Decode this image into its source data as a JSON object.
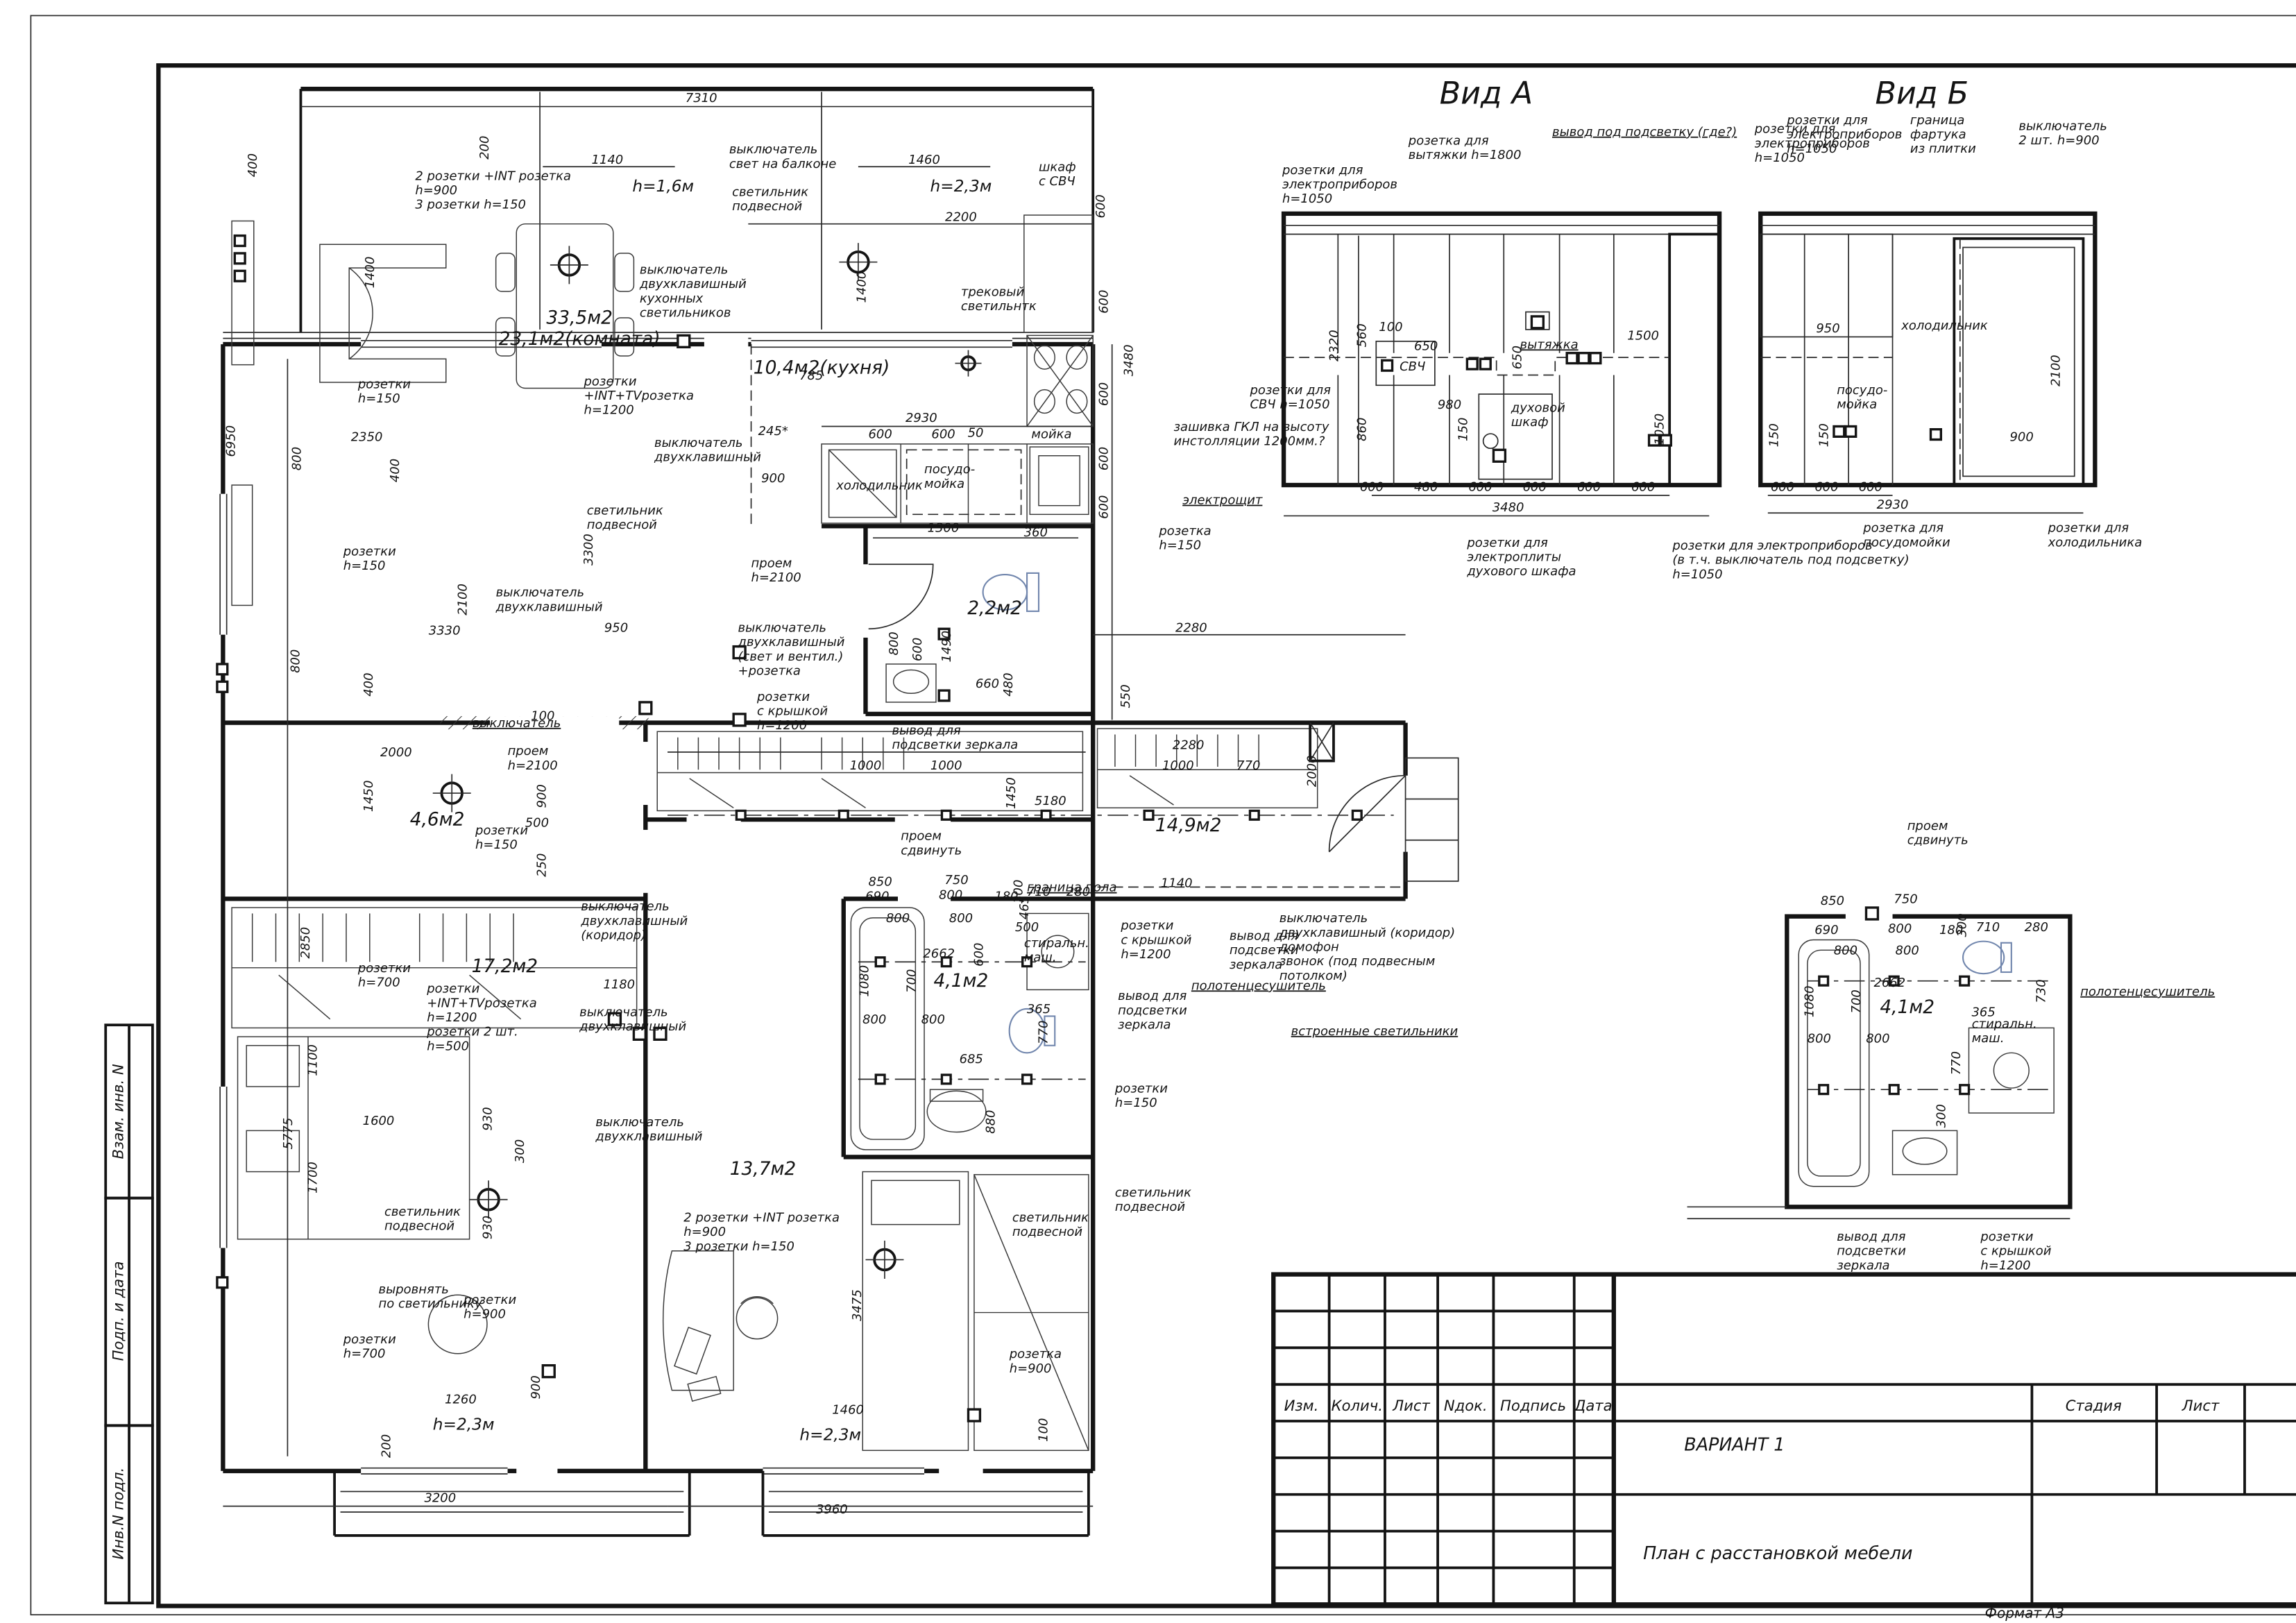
{
  "colors": {
    "line": "#141414",
    "toilet_outline": "#7186ad",
    "paper": "#ffffff"
  },
  "stamp": {
    "cells": [
      "Взам. инв. N",
      "Подп. и дата",
      "Инв.N подл."
    ]
  },
  "titleblock": {
    "cols": [
      "Изм.",
      "Колич.",
      "Лист",
      "Nдок.",
      "Подпись",
      "Дата"
    ],
    "variant": "ВАРИАНТ 1",
    "stage_label": "Стадия",
    "sheet_label": "Лист",
    "sheets_label": "Листов",
    "title": "План с расстановкой мебели",
    "format": "Формат А3"
  },
  "view_a": {
    "title": "Вид А",
    "labels": [
      {
        "t": "розетка для\nвытяжки h=1800"
      },
      {
        "t": "вывод под подсветку (где?)"
      },
      {
        "t": "розетки для\nэлектроприборов\nh=1050"
      },
      {
        "t": "розетки для\nэлектроприборов\nh=1050"
      },
      {
        "t": "вытяжка"
      },
      {
        "t": "СВЧ"
      },
      {
        "t": "100"
      },
      {
        "t": "650"
      },
      {
        "t": "650"
      },
      {
        "t": "1500"
      },
      {
        "t": "2320"
      },
      {
        "t": "560"
      },
      {
        "t": "860"
      },
      {
        "t": "980"
      },
      {
        "t": "150"
      },
      {
        "t": "духовой\nшкаф"
      },
      {
        "t": "1050"
      },
      {
        "t": "розетки для\nСВЧ h=1050"
      },
      {
        "t": "600"
      },
      {
        "t": "480"
      },
      {
        "t": "600"
      },
      {
        "t": "600"
      },
      {
        "t": "600"
      },
      {
        "t": "600"
      },
      {
        "t": "3480"
      },
      {
        "t": "розетки для\nэлектроплиты\nдухового шкафа"
      },
      {
        "t": "розетки для электроприборов\n(в т.ч. выключатель под подсветку)\nh=1050"
      }
    ]
  },
  "view_b": {
    "title": "Вид Б",
    "labels": [
      {
        "t": "розетки для\nэлектроприборов\nh=1050"
      },
      {
        "t": "граница\nфартука\nиз плитки"
      },
      {
        "t": "выключатель\n2 шт. h=900"
      },
      {
        "t": "холодильник"
      },
      {
        "t": "950"
      },
      {
        "t": "2100"
      },
      {
        "t": "900"
      },
      {
        "t": "150"
      },
      {
        "t": "150"
      },
      {
        "t": "посудо-\nмойка"
      },
      {
        "t": "600"
      },
      {
        "t": "600"
      },
      {
        "t": "600"
      },
      {
        "t": "2930"
      },
      {
        "t": "розетка для\nпосудомойки"
      },
      {
        "t": "розетки для\nхолодильника"
      }
    ]
  },
  "detail": {
    "labels": [
      {
        "t": "проем\nсдвинуть"
      },
      {
        "t": "полотенцесушитель"
      },
      {
        "t": "850"
      },
      {
        "t": "750"
      },
      {
        "t": "690"
      },
      {
        "t": "800"
      },
      {
        "t": "180"
      },
      {
        "t": "300"
      },
      {
        "t": "710"
      },
      {
        "t": "280"
      },
      {
        "t": "800"
      },
      {
        "t": "800"
      },
      {
        "t": "2662"
      },
      {
        "t": "730"
      },
      {
        "t": "стиральн.\nмаш."
      },
      {
        "t": "4,1м2"
      },
      {
        "t": "700"
      },
      {
        "t": "1080"
      },
      {
        "t": "800"
      },
      {
        "t": "800"
      },
      {
        "t": "365"
      },
      {
        "t": "770"
      },
      {
        "t": "300"
      },
      {
        "t": "вывод для\nподсветки\nзеркала"
      },
      {
        "t": "розетки\nс крышкой\nh=1200"
      }
    ]
  },
  "plan": {
    "labels": [
      {
        "t": "7310"
      },
      {
        "t": "200"
      },
      {
        "t": "1140"
      },
      {
        "t": "h=1,6м"
      },
      {
        "t": "2 розетки +INT розетка\nh=900\n3 розетки h=150"
      },
      {
        "t": "выключатель\nсвет на балконе"
      },
      {
        "t": "светильник\nподвесной"
      },
      {
        "t": "1460"
      },
      {
        "t": "h=2,3м"
      },
      {
        "t": "шкаф\nс СВЧ"
      },
      {
        "t": "2200"
      },
      {
        "t": "600"
      },
      {
        "t": "1400"
      },
      {
        "t": "400"
      },
      {
        "t": "6950"
      },
      {
        "t": "розетки\nh=150"
      },
      {
        "t": "2350"
      },
      {
        "t": "33,5м2\n23,1м2(комната)"
      },
      {
        "t": "выключатель\nдвухклавишный\nкухонных\nсветильников"
      },
      {
        "t": "розетки\n+INT+TVрозетка\nh=1200"
      },
      {
        "t": "светильник\nподвесной"
      },
      {
        "t": "10,4м2(кухня)"
      },
      {
        "t": "трековый\nсветильнтк"
      },
      {
        "t": "1400"
      },
      {
        "t": "785"
      },
      {
        "t": "3480"
      },
      {
        "t": "600"
      },
      {
        "t": "600"
      },
      {
        "t": "600"
      },
      {
        "t": "600"
      },
      {
        "t": "2930"
      },
      {
        "t": "245*"
      },
      {
        "t": "600"
      },
      {
        "t": "600"
      },
      {
        "t": "50"
      },
      {
        "t": "мойка"
      },
      {
        "t": "900"
      },
      {
        "t": "выключатель\nдвухклавишный"
      },
      {
        "t": "холодильник"
      },
      {
        "t": "посудо-\nмойка"
      },
      {
        "t": "зашивка ГКЛ на высоту\nинстолляции 1200мм.?"
      },
      {
        "t": "электрощит"
      },
      {
        "t": "розетка\nh=150"
      },
      {
        "t": "1300"
      },
      {
        "t": "360"
      },
      {
        "t": "проем\nh=2100"
      },
      {
        "t": "2,2м2"
      },
      {
        "t": "800"
      },
      {
        "t": "600"
      },
      {
        "t": "1490"
      },
      {
        "t": "660"
      },
      {
        "t": "480"
      },
      {
        "t": "выключатель\nдвухклавишный\n(свет и вентил.)\n+розетка"
      },
      {
        "t": "розетки\nс крышкой\nh=1200"
      },
      {
        "t": "вывод для\nподсветки зеркала"
      },
      {
        "t": "розетки\nh=150"
      },
      {
        "t": "3330"
      },
      {
        "t": "950"
      },
      {
        "t": "800"
      },
      {
        "t": "400"
      },
      {
        "t": "2100"
      },
      {
        "t": "3300"
      },
      {
        "t": "выключатель\nдвухклавишный"
      },
      {
        "t": "выключатель"
      },
      {
        "t": "100"
      },
      {
        "t": "2000"
      },
      {
        "t": "1450"
      },
      {
        "t": "проем\nh=2100"
      },
      {
        "t": "900"
      },
      {
        "t": "4,6м2"
      },
      {
        "t": "розетки\nh=150"
      },
      {
        "t": "500"
      },
      {
        "t": "550"
      },
      {
        "t": "2280"
      },
      {
        "t": "2280"
      },
      {
        "t": "1000"
      },
      {
        "t": "770"
      },
      {
        "t": "2000"
      },
      {
        "t": "14,9м2"
      },
      {
        "t": "1000"
      },
      {
        "t": "1000"
      },
      {
        "t": "1450"
      },
      {
        "t": "5180"
      },
      {
        "t": "проем\nсдвинуть"
      },
      {
        "t": "граница пола"
      },
      {
        "t": "1140"
      },
      {
        "t": "465"
      },
      {
        "t": "выключатель\nдвухклавишный (коридор)\nдомофон\nзвонок (под подвесным\nпотолком)"
      },
      {
        "t": "встроенные светильники"
      },
      {
        "t": "вывод для\nподсветки\nзеркала"
      },
      {
        "t": "полотенцесушитель"
      },
      {
        "t": "розетки\nс крышкой\nh=1200"
      },
      {
        "t": "вывод для\nподсветки\nзеркала"
      },
      {
        "t": "розетки\nh=150"
      },
      {
        "t": "светильник\nподвесной"
      },
      {
        "t": "13,7м2"
      },
      {
        "t": "2 розетки +INT розетка\nh=900\n3 розетки h=150"
      },
      {
        "t": "светильник\nподвесной"
      },
      {
        "t": "3475"
      },
      {
        "t": "розетка\nh=900"
      },
      {
        "t": "1460"
      },
      {
        "t": "h=2,3м"
      },
      {
        "t": "100"
      },
      {
        "t": "3960"
      },
      {
        "t": "светильник\nподвесной"
      },
      {
        "t": "930"
      },
      {
        "t": "выровнять\nпо светильнику"
      },
      {
        "t": "розетки\nh=900"
      },
      {
        "t": "розетки\nh=700"
      },
      {
        "t": "900"
      },
      {
        "t": "1260"
      },
      {
        "t": "h=2,3м"
      },
      {
        "t": "200"
      },
      {
        "t": "3200"
      },
      {
        "t": "250"
      },
      {
        "t": "выключатель\nдвухклавишный\n(коридор)"
      },
      {
        "t": "17,2м2"
      },
      {
        "t": "розетки\nh=700"
      },
      {
        "t": "розетки\n+INT+TVрозетка\nh=1200\nрозетки 2 шт.\nh=500"
      },
      {
        "t": "1180"
      },
      {
        "t": "выключатель\nдвухклавишный"
      },
      {
        "t": "1600"
      },
      {
        "t": "930"
      },
      {
        "t": "300"
      },
      {
        "t": "выключатель\nдвухклавишный"
      },
      {
        "t": "5775"
      },
      {
        "t": "2850"
      },
      {
        "t": "1100"
      },
      {
        "t": "1700"
      },
      {
        "t": "800"
      },
      {
        "t": "400"
      },
      {
        "t": "850"
      },
      {
        "t": "750"
      },
      {
        "t": "690"
      },
      {
        "t": "800"
      },
      {
        "t": "180"
      },
      {
        "t": "300"
      },
      {
        "t": "710"
      },
      {
        "t": "280"
      },
      {
        "t": "800"
      },
      {
        "t": "800"
      },
      {
        "t": "2662"
      },
      {
        "t": "600"
      },
      {
        "t": "500"
      },
      {
        "t": "стиральн.\nмаш."
      },
      {
        "t": "4,1м2"
      },
      {
        "t": "700"
      },
      {
        "t": "1080"
      },
      {
        "t": "800"
      },
      {
        "t": "800"
      },
      {
        "t": "365"
      },
      {
        "t": "770"
      },
      {
        "t": "685"
      },
      {
        "t": "880"
      }
    ]
  }
}
